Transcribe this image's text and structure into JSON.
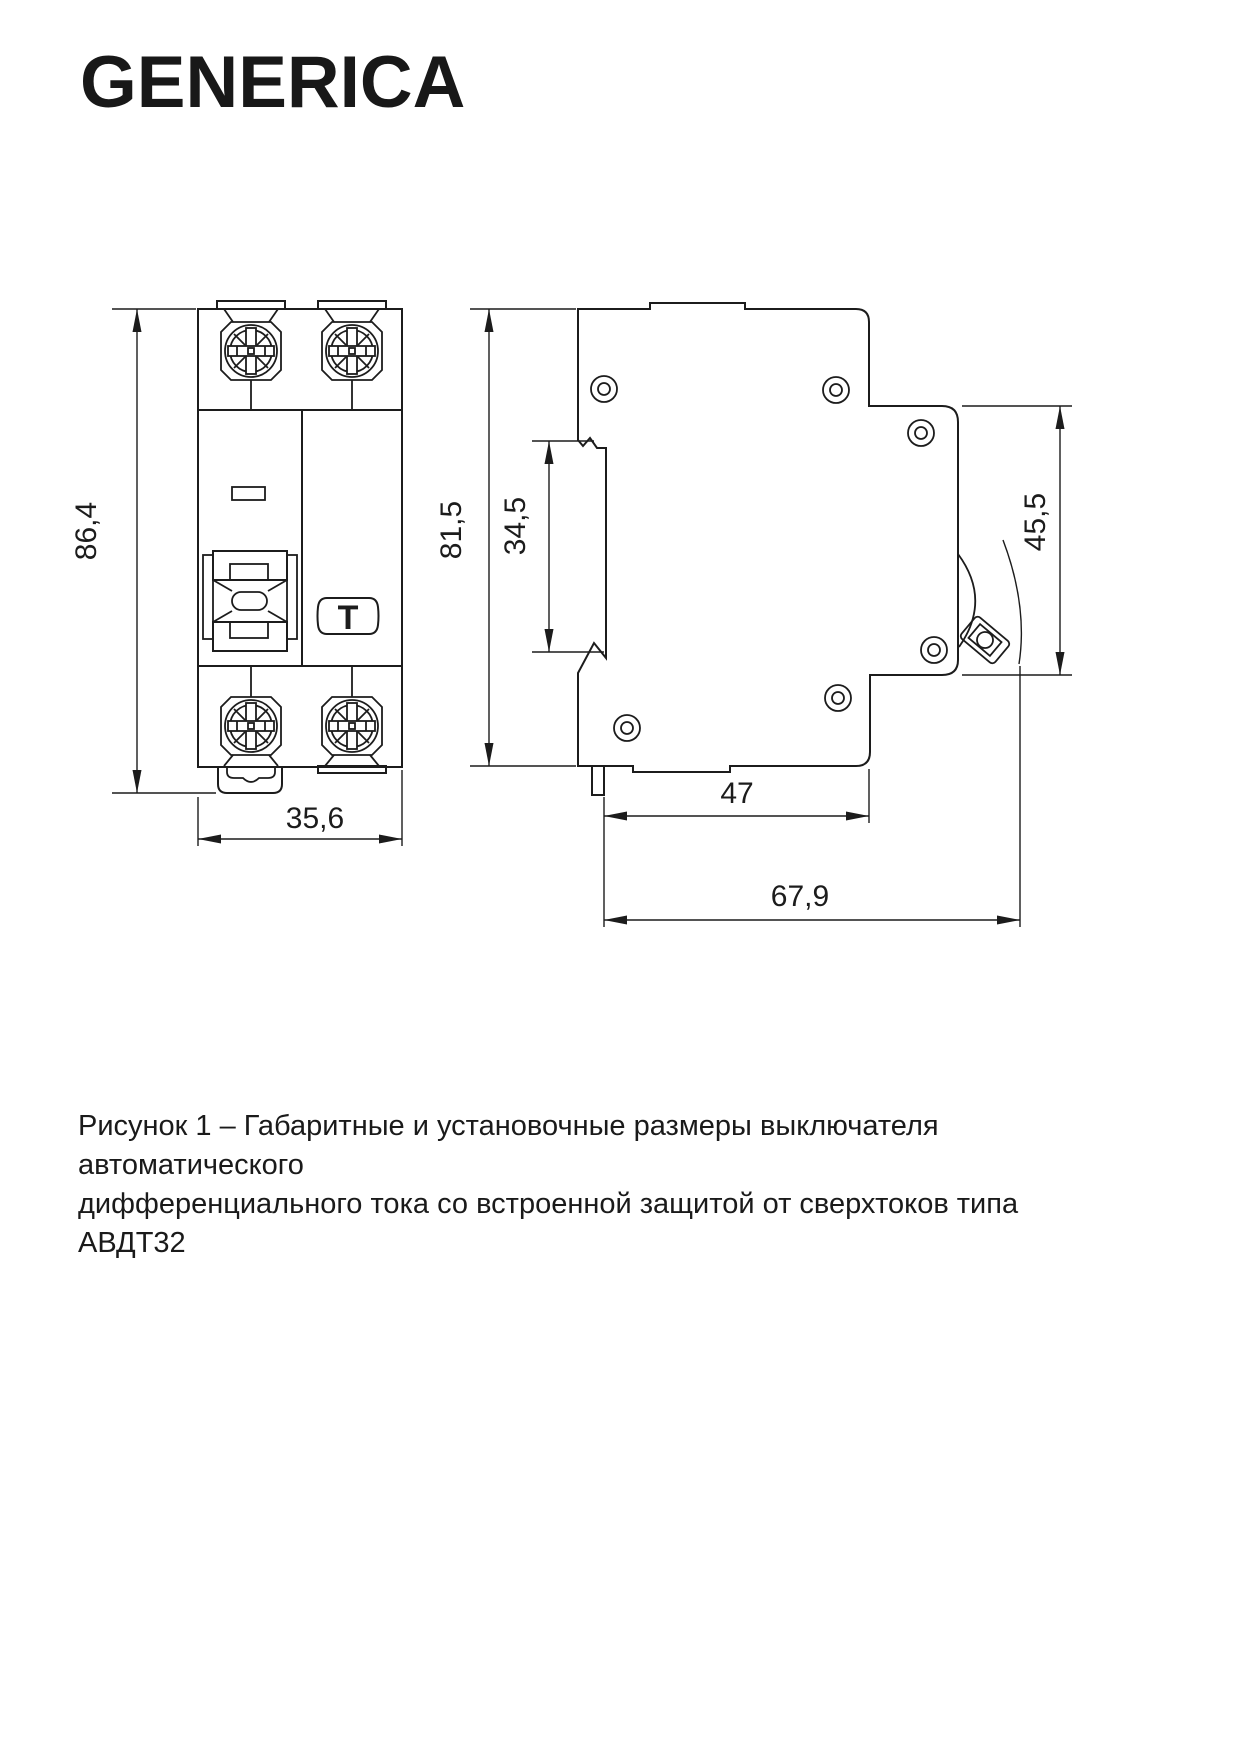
{
  "brand": {
    "logo_text": "GENERICA"
  },
  "drawing": {
    "front_view": {
      "height_mm": "86,4",
      "width_mm": "35,6",
      "test_button_label": "T"
    },
    "side_view": {
      "height_mm": "81,5",
      "din_recess_mm": "34,5",
      "front_panel_mm": "45,5",
      "depth_body_mm": "47",
      "depth_total_mm": "67,9"
    }
  },
  "caption": {
    "line1": "Рисунок 1 – Габаритные и установочные размеры выключателя автоматического",
    "line2": "дифференциального тока со встроенной защитой от сверхтоков типа АВДТ32"
  },
  "colors": {
    "line": "#1c1c1c",
    "text": "#1a1a1a",
    "background": "#ffffff"
  }
}
